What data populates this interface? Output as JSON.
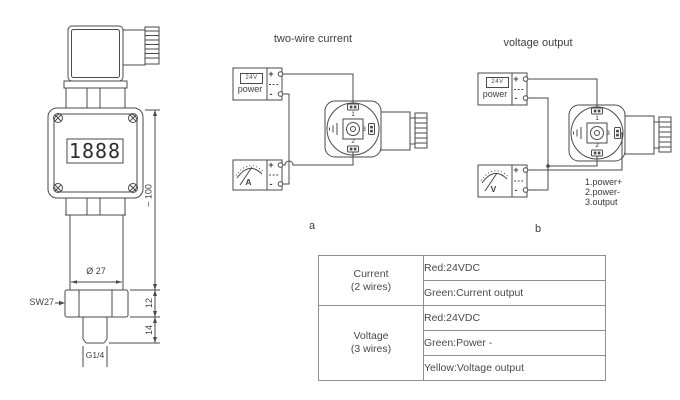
{
  "titles": {
    "diagram_a": "two-wire current",
    "diagram_b": "voltage output"
  },
  "captions": {
    "a": "a",
    "b": "b"
  },
  "transmitter": {
    "display": "1888",
    "dims": {
      "height": "~ 100",
      "diameter": "Ø 27",
      "hex_height": "12",
      "thread_height": "14",
      "wrench": "SW27",
      "thread": "G1/4"
    }
  },
  "power_supply": {
    "label": "power",
    "badge": "24V"
  },
  "meters": {
    "ammeter": "A",
    "voltmeter": "V"
  },
  "symbols": {
    "plus": "+",
    "minus": "-"
  },
  "pins": {
    "p1": "1",
    "p2": "2",
    "p3": "3"
  },
  "legend_b": [
    "1.power+",
    "2.power-",
    "3.output"
  ],
  "table": {
    "groups": [
      {
        "label_line1": "Current",
        "label_line2": "(2 wires)",
        "rows": [
          "Red:24VDC",
          "Green:Current output"
        ]
      },
      {
        "label_line1": "Voltage",
        "label_line2": "(3 wires)",
        "rows": [
          "Red:24VDC",
          "Green:Power -",
          "Yellow:Voltage output"
        ]
      }
    ]
  }
}
